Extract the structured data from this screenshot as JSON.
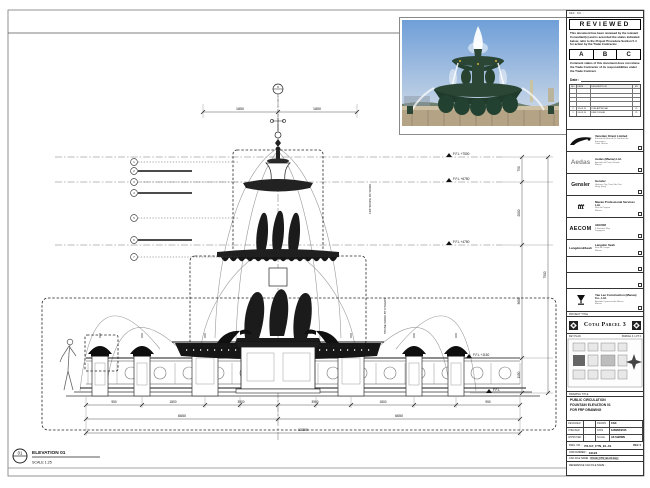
{
  "stamp": {
    "header": "REF. NO. :",
    "title": "REVIEWED",
    "para1": "This document has been reviewed by the relevant Consultant(s) and is accorded the status indicated below, refer to the Project Procedure Section 5.4 for action by the Trade Contractor.",
    "grade_a": "A",
    "grade_b": "B",
    "grade_c": "C",
    "para2": "Comment status of this document does not relieve the Trade Contractor of its responsibilities under the Trade Contract.",
    "date_label": "Date :"
  },
  "revisions": {
    "headers": [
      "NO.",
      "DATE",
      "DESCRIPTION",
      "BY"
    ],
    "rows": [
      {
        "no": "",
        "date": "",
        "desc": "",
        "by": ""
      },
      {
        "no": "",
        "date": "",
        "desc": "",
        "by": ""
      },
      {
        "no": "",
        "date": "",
        "desc": "",
        "by": ""
      },
      {
        "no": "",
        "date": "",
        "desc": "",
        "by": ""
      },
      {
        "no": "2",
        "date": "10.04.15",
        "desc": "FOR APPROVAL",
        "by": "YL"
      },
      {
        "no": "1",
        "date": "26.03.15",
        "desc": "FIRST ISSUE",
        "by": "YL"
      }
    ]
  },
  "consultants": [
    {
      "name": "Venetian Orient Limited",
      "logo": "",
      "addr1": "Estrada da Baia de N. Senhora da Esperanca",
      "addr2": "Cotai, Macau"
    },
    {
      "name": "Aedas (Macau) Ltd.",
      "logo": "Aedas",
      "addr1": "Avenida da Praia Grande",
      "addr2": "Macau"
    },
    {
      "name": "Gensler",
      "logo": "Gensler",
      "addr1": "Harbour City, Tsim Sha Tsui",
      "addr2": "Hong Kong"
    },
    {
      "name": "Macau Professional Services Ltd.",
      "logo": "ttt",
      "addr1": "Rua de Pequim",
      "addr2": "Macau"
    },
    {
      "name": "AECOM",
      "logo": "AECOM",
      "addr1": "8 Shenton Way",
      "addr2": "Singapore"
    },
    {
      "name": "Langdon Seah",
      "logo": "Langdon&Seah",
      "addr1": "Rua do Campo",
      "addr2": "Macau"
    },
    {
      "name": "",
      "logo": "",
      "addr1": "",
      "addr2": ""
    },
    {
      "name": "",
      "logo": "",
      "addr1": "",
      "addr2": ""
    },
    {
      "name": "Yau Lee Construction (Macau) Co., Ltd.",
      "logo": "",
      "addr1": "Avenida Comercial de Macau",
      "addr2": "Macau"
    }
  ],
  "project": {
    "label": "PROJECT TITLE",
    "name": "Cotai Parcel 3"
  },
  "key_plan": {
    "label": "KEY PLAN",
    "area": "PARCEL 3, LOT 2"
  },
  "title_box": {
    "label": "DRAWING TITLE",
    "line1": "PUBLIC CIRCULATION",
    "line2": "FOUNTAIN ELEVATION 01",
    "line3": "FOR FRP DRAWING"
  },
  "fields": {
    "designed_label": "DESIGNED",
    "designed": "",
    "drawn_label": "DRAWN",
    "drawn": "CAD",
    "checked_label": "CHECKED",
    "checked": "-",
    "date_label": "DATE",
    "date": "12/MAR/2015",
    "approved_label": "APPROVED",
    "approved": "-",
    "scale_label": "SCALE",
    "scale": "AS SHOWN"
  },
  "dwg": {
    "label": "DWG. NO. :",
    "no": "P3-GF_FTN_EL-01",
    "rev": "REV. 0"
  },
  "job": {
    "label": "JOB NUMBER :",
    "no": "31123"
  },
  "cad_file": {
    "label": "CAD FILE NAME :",
    "name": "P3-GF_FTN_EL-01.dwg"
  },
  "ref_file": {
    "label": "REFERENCE CAD FILE NAME :"
  },
  "elevation": {
    "bubble": "01",
    "title": "ELEVATION 01",
    "scale": "SCALE 1:25"
  },
  "levels": [
    "F.F.L +7500",
    "F.F.L +6750",
    "F.F.L +4750",
    "F.F.L +1150",
    "F.F.L"
  ],
  "dims": {
    "top_left": "1850",
    "top_right": "1850",
    "r1": "750",
    "r2": "2000",
    "r3": "3600",
    "r4": "1150",
    "r_total": "7500",
    "b1": "950",
    "b2": "1800",
    "b3": "3900",
    "b4": "3900",
    "b5": "1800",
    "b6": "950",
    "half_l": "6650",
    "half_r": "6650",
    "total": "13300"
  },
  "callouts": {
    "top": "8",
    "c1": "1",
    "c2": "2",
    "c3": "3",
    "c4": "4",
    "c5": "5",
    "c6": "6",
    "c7": "7"
  },
  "notes": {
    "frp": "FRP SCOPE OF WORK",
    "stone": "STONE WORK BY OTHERS"
  }
}
